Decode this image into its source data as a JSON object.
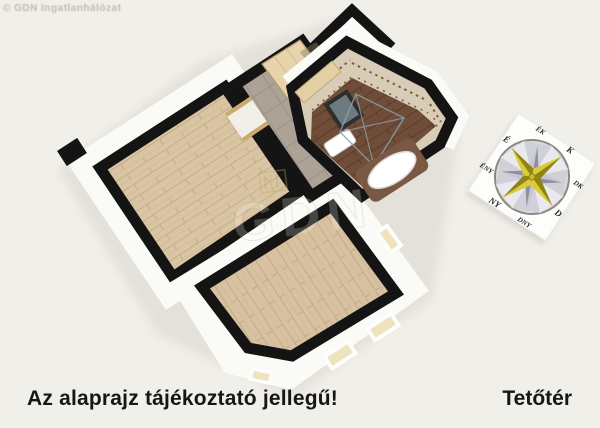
{
  "watermark_topleft": "© GDN Ingatlanhálózat",
  "center_watermark": "GDN",
  "footer": {
    "disclaimer": "Az alaprajz tájékoztató jellegű!",
    "floor_label": "Tetőtér"
  },
  "compass": {
    "n": "É",
    "ne": "ÉK",
    "e": "K",
    "se": "DK",
    "s": "D",
    "sw": "DNY",
    "w": "NY",
    "nw": "ÉNY"
  },
  "colors": {
    "background": "#f1efe9",
    "wall_cap": "#141414",
    "wall_face": "#fafaf7",
    "wood_light": "#d9c4a3",
    "wood_dark": "#6f4d39",
    "tile_gray": "#aca396",
    "bath_tile": "#d9ccb6",
    "compass_gold": "#c9ba32",
    "text": "#161616"
  }
}
